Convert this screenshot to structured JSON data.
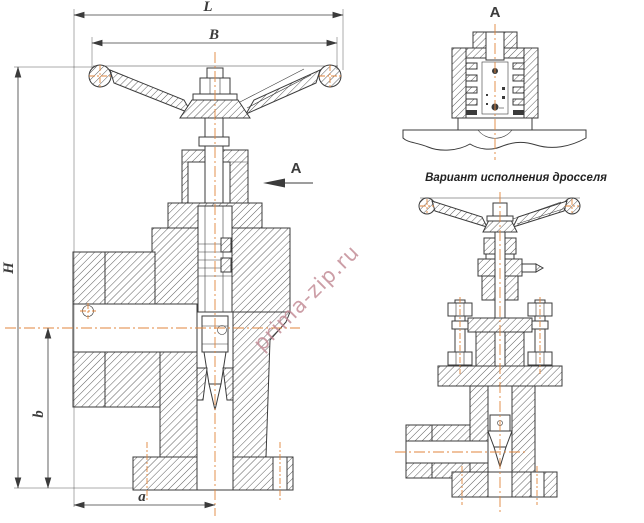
{
  "colors": {
    "line": "#3b3b3b",
    "centerline": "#e0853c",
    "watermark": "#c08691",
    "bg": "#ffffff"
  },
  "labels": {
    "dim_L": "L",
    "dim_B": "B",
    "dim_H": "H",
    "dim_b": "b",
    "dim_a": "a",
    "section_arrow": "A",
    "section_view_title": "A",
    "variant_caption": "Вариант исполнения дросселя",
    "watermark": "prima-zip.ru"
  }
}
